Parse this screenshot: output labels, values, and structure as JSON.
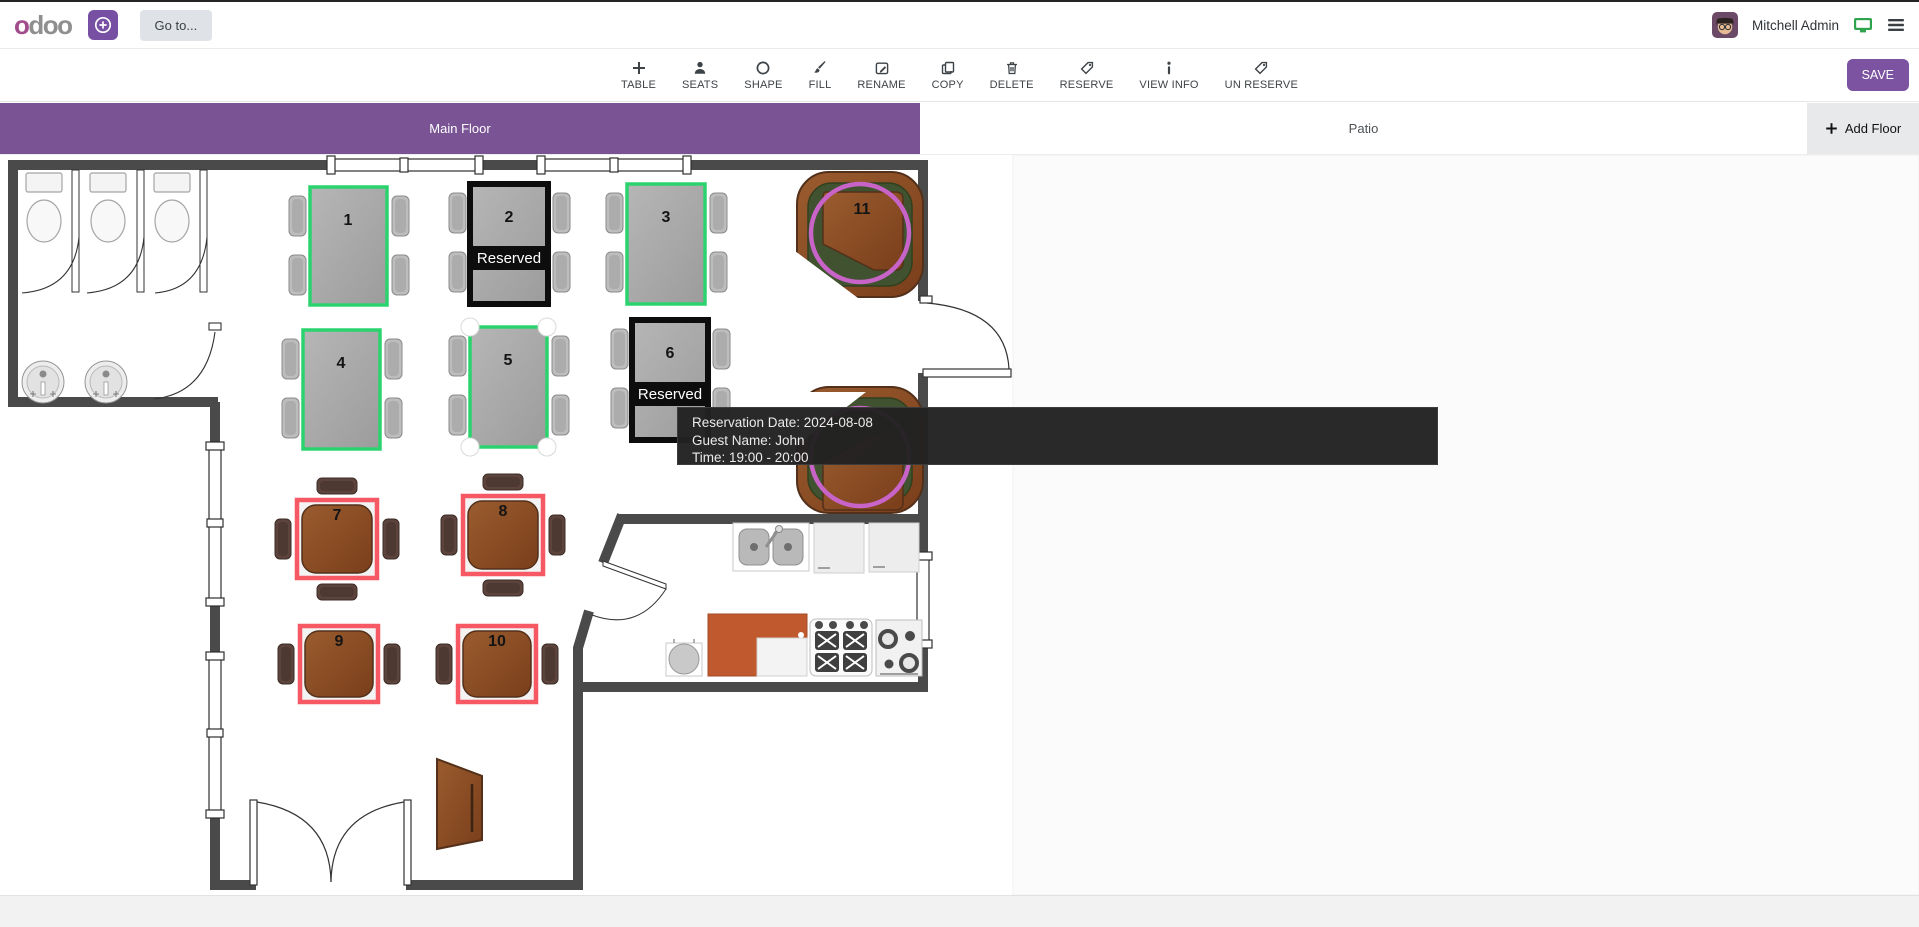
{
  "navbar": {
    "logo": "odoo",
    "goto_label": "Go to...",
    "user_name": "Mitchell Admin"
  },
  "toolbar": {
    "items": [
      {
        "label": "TABLE",
        "icon": "plus-icon"
      },
      {
        "label": "SEATS",
        "icon": "person-icon"
      },
      {
        "label": "SHAPE",
        "icon": "circle-icon"
      },
      {
        "label": "FILL",
        "icon": "brush-icon"
      },
      {
        "label": "RENAME",
        "icon": "edit-icon"
      },
      {
        "label": "COPY",
        "icon": "copy-icon"
      },
      {
        "label": "DELETE",
        "icon": "trash-icon"
      },
      {
        "label": "RESERVE",
        "icon": "tag-icon"
      },
      {
        "label": "VIEW INFO",
        "icon": "info-icon"
      },
      {
        "label": "UN RESERVE",
        "icon": "tag-icon"
      }
    ],
    "save_label": "SAVE"
  },
  "floors": {
    "tabs": [
      {
        "label": "Main Floor",
        "active": true
      },
      {
        "label": "Patio",
        "active": false
      }
    ],
    "add_floor_label": "Add Floor"
  },
  "plan": {
    "tables": [
      {
        "number": "1",
        "shape": "rect",
        "status": "available"
      },
      {
        "number": "2",
        "shape": "rect",
        "status": "reserved",
        "status_label": "Reserved"
      },
      {
        "number": "3",
        "shape": "rect",
        "status": "available"
      },
      {
        "number": "4",
        "shape": "rect",
        "status": "available"
      },
      {
        "number": "5",
        "shape": "rect",
        "status": "selected"
      },
      {
        "number": "6",
        "shape": "rect",
        "status": "reserved",
        "status_label": "Reserved"
      },
      {
        "number": "7",
        "shape": "square",
        "status": "highlighted"
      },
      {
        "number": "8",
        "shape": "square",
        "status": "highlighted"
      },
      {
        "number": "9",
        "shape": "square",
        "status": "highlighted"
      },
      {
        "number": "10",
        "shape": "square",
        "status": "highlighted"
      },
      {
        "number": "11",
        "shape": "booth",
        "status": "available"
      }
    ]
  },
  "tooltip": {
    "line1": "Reservation Date: 2024-08-08",
    "line2": "Guest Name: John",
    "line3": "Time: 19:00 - 20:00"
  },
  "colors": {
    "accent_purple": "#7a5394",
    "available_green": "#2bd36e",
    "highlight_red": "#f75964",
    "reserved_black": "#0d0d0d",
    "booth_ring_magenta": "#c863c8",
    "wall_gray": "#4a4a4a"
  }
}
